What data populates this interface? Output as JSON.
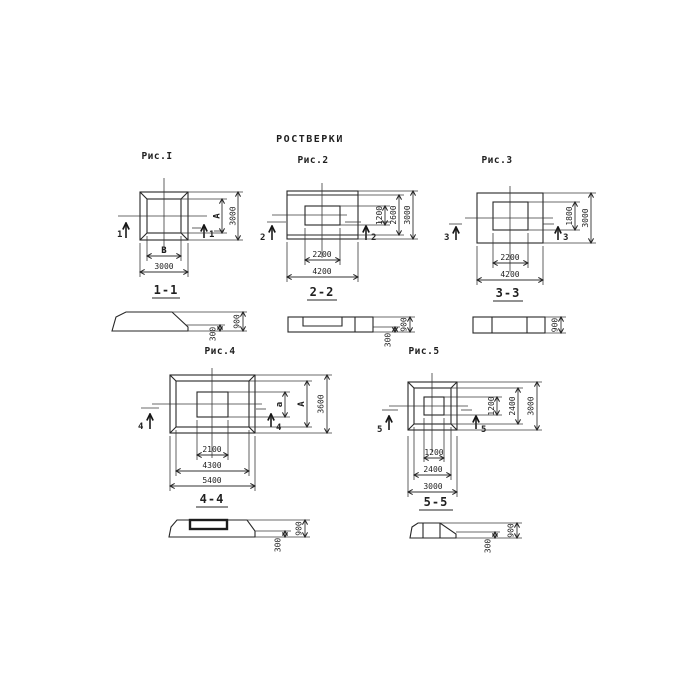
{
  "title": "РОСТВЕРКИ",
  "figures": [
    {
      "caption": "Рис.I",
      "cut_mark": "1",
      "section_label": "1-1",
      "dims": {
        "inner_width": "B",
        "outer_width": "3000",
        "inner_height": "A",
        "outer_height": "3000"
      }
    },
    {
      "caption": "Рис.2",
      "cut_mark": "2",
      "section_label": "2-2",
      "dims": {
        "inner_width": "2200",
        "outer_width": "4200",
        "inner_height": "1200",
        "mid_height": "2600",
        "outer_height": "3000"
      }
    },
    {
      "caption": "Рис.3",
      "cut_mark": "3",
      "section_label": "3-3",
      "dims": {
        "inner_width": "2200",
        "outer_width": "4200",
        "inner_height": "1800",
        "outer_height": "3000"
      }
    },
    {
      "caption": "Рис.4",
      "cut_mark": "4",
      "section_label": "4-4",
      "dims": {
        "inner_width": "2100",
        "mid_width": "4300",
        "outer_width": "5400",
        "inner_height": "a",
        "mid_height": "A",
        "outer_height": "3600"
      }
    },
    {
      "caption": "Рис.5",
      "cut_mark": "5",
      "section_label": "5-5",
      "dims": {
        "inner_width": "1200",
        "mid_width": "2400",
        "outer_width": "3000",
        "inner_height": "1200",
        "mid_height": "2400",
        "outer_height": "3000"
      }
    }
  ],
  "sections": [
    {
      "step_height": "300",
      "total_height": "900"
    },
    {
      "step_height": "300",
      "total_height": "900"
    },
    {
      "total_height": "900"
    },
    {
      "step_height": "300",
      "total_height": "900"
    },
    {
      "step_height": "300",
      "total_height": "900"
    }
  ]
}
